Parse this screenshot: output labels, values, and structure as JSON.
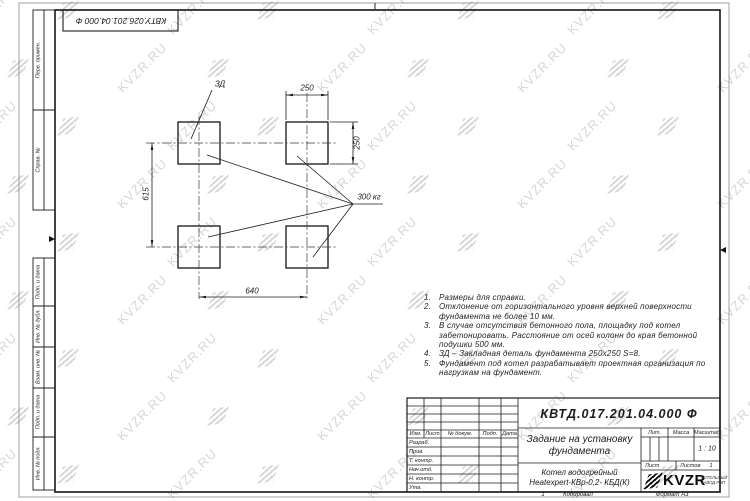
{
  "sheet": {
    "top_stamp": "КВТУ.026.201.04.000 Ф",
    "watermark": {
      "text": "KVZR.RU",
      "color": "#d7d7d7"
    },
    "footer": {
      "num": "1",
      "copied_label": "Копировал",
      "format_label": "Формат А3"
    }
  },
  "margin_columns": [
    {
      "label": "Перв. примен."
    },
    {
      "label": "Справ. №"
    },
    {
      "label": "Подп. и дата"
    },
    {
      "label": "Инв. № дубл."
    },
    {
      "label": "Взам. инв. №"
    },
    {
      "label": "Подп. и дата"
    },
    {
      "label": "Инв. № подл."
    }
  ],
  "drawing": {
    "labels": {
      "zd": "ЗД",
      "load": "300 кг",
      "dim_pad_width": "250",
      "dim_pad_height": "250",
      "dim_row_spacing": "615",
      "dim_col_spacing": "640"
    }
  },
  "notes": {
    "items": [
      {
        "num": "1.",
        "text": "Размеры для справки."
      },
      {
        "num": "2.",
        "text": "Отклонение от горизонтального уровня верхней поверхности фундамента не более 10 мм."
      },
      {
        "num": "3.",
        "text": "В случае отсутствия бетонного пола, площадку под котел забетонировать. Расстояние от осей колонн до края бетонной подушки 500 мм."
      },
      {
        "num": "4.",
        "text": "ЗД – Закладная деталь фундамента 250х250 S=8."
      },
      {
        "num": "5.",
        "text": "Фундамент под котел разрабатывает проектная организация по нагрузкам на фундамент."
      }
    ]
  },
  "title_block": {
    "designation": "КВТД.017.201.04.000 Ф",
    "title_line1": "Задание на установку",
    "title_line2": "фундамента",
    "product_line1": "Котел водогрейный",
    "product_line2": "Heatexpert-КВр-0,2- КБД(К)",
    "header_cols": [
      "Изм.",
      "Лист",
      "№ докум.",
      "Подп.",
      "Дата"
    ],
    "sig_rows": [
      "Разраб.",
      "Пров.",
      "Т. контр.",
      "Нач.отд.",
      "Н. контр.",
      "Утв."
    ],
    "lit_label": "Лит.",
    "mass_label": "Масса",
    "scale_label": "Масштаб",
    "scale_value": "1 : 10",
    "sheet_label": "Лист",
    "sheets_label": "Листов",
    "sheets_value": "1",
    "company": {
      "logo_text": "KVZR",
      "tagline_line1": "КОТЕЛЬНЫЙ",
      "tagline_line2": "ЗАВОД РЭП"
    }
  }
}
